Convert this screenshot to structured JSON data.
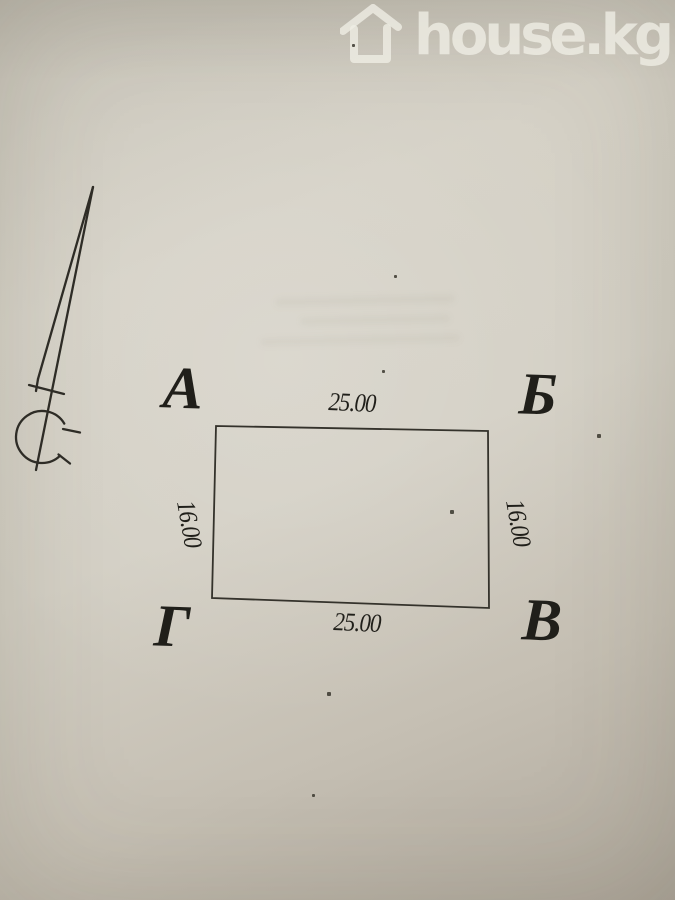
{
  "watermark": {
    "brand": "house.kg",
    "icon": "house-outline-icon",
    "color": "#eeebe2"
  },
  "plan": {
    "corner_labels": {
      "top_left": "А",
      "top_right": "Б",
      "bottom_right": "В",
      "bottom_left": "Г"
    },
    "dimensions": {
      "top": "25.00",
      "bottom": "25.00",
      "left": "16.00",
      "right": "16.00"
    },
    "north": {
      "letter": "С",
      "icon": "north-arrow-icon"
    }
  },
  "colors": {
    "paper": "#cfcbc0",
    "ink": "#2e2c26",
    "watermark": "#eeebe2"
  }
}
